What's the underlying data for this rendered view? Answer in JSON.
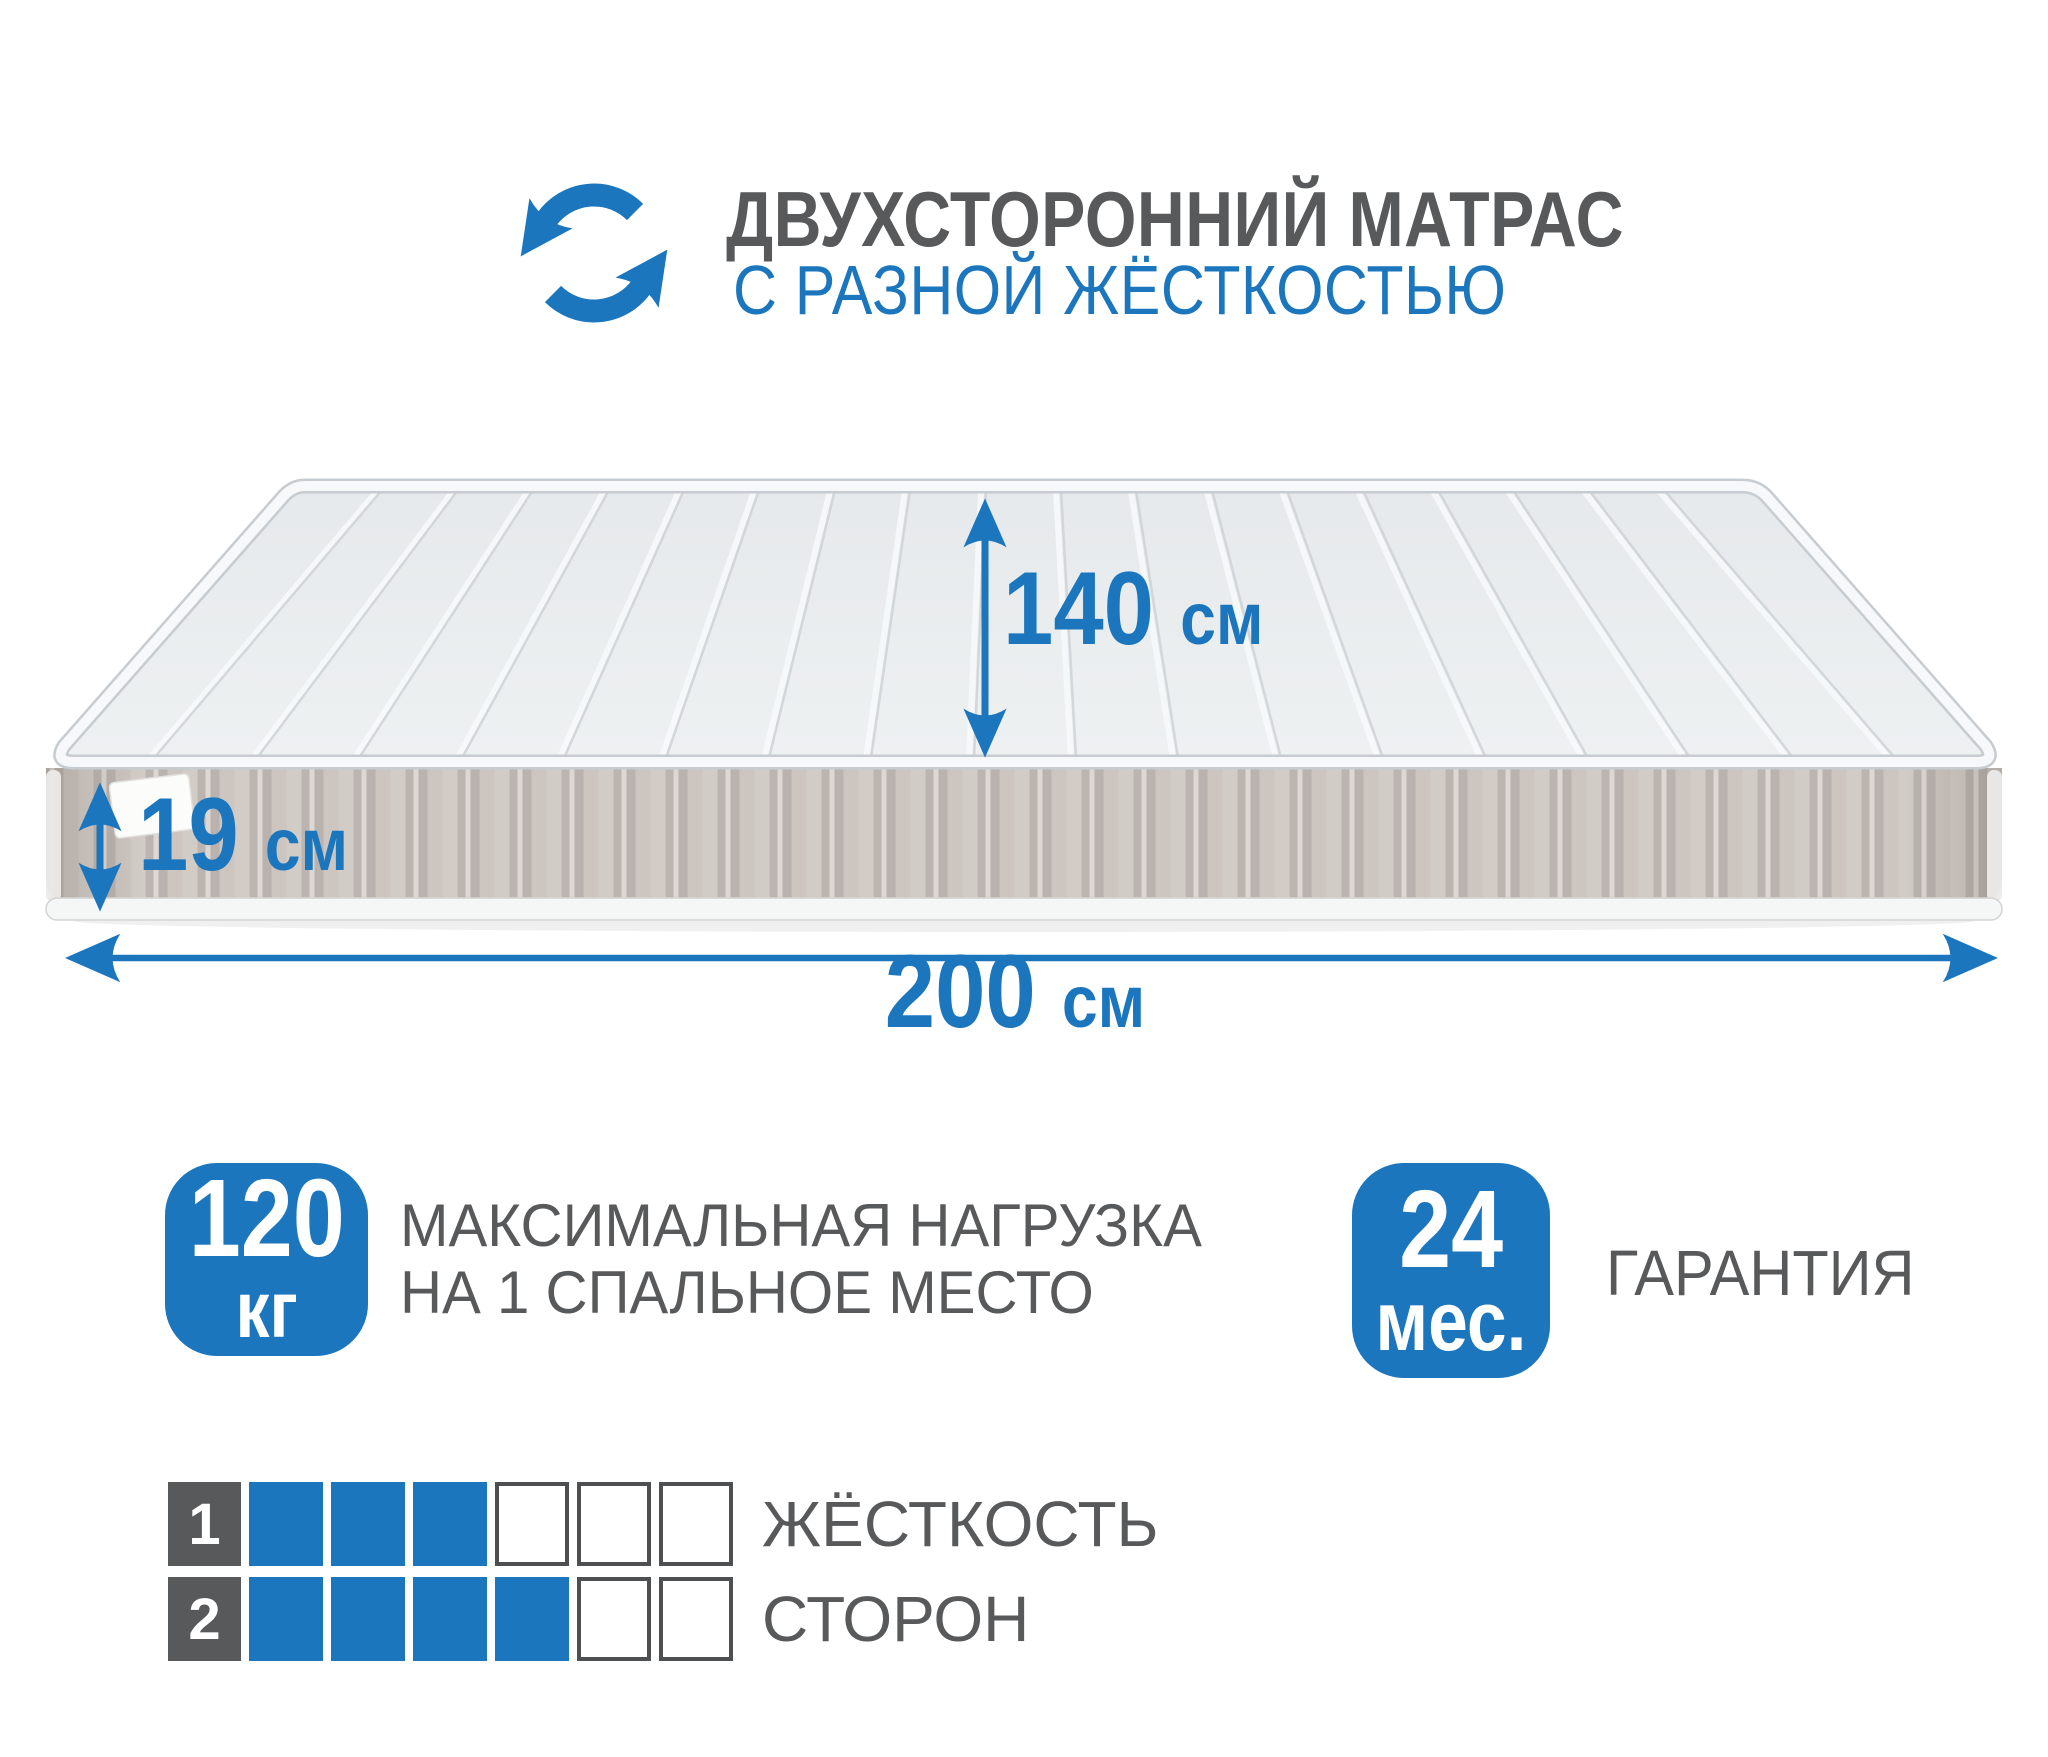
{
  "colors": {
    "accent_blue": "#1b76bd",
    "text_gray": "#58595b",
    "mattress_top": "#e9ecee",
    "mattress_side": "#c9c2bd"
  },
  "header": {
    "icon": "rotate-arrows-icon",
    "title": "ДВУХСТОРОННИЙ МАТРАС",
    "subtitle": "С РАЗНОЙ ЖЁСТКОСТЬЮ"
  },
  "dimensions": {
    "width": {
      "value": "140",
      "unit": "см"
    },
    "height": {
      "value": "19",
      "unit": "см"
    },
    "length": {
      "value": "200",
      "unit": "см"
    }
  },
  "badges": {
    "max_load": {
      "value": "120",
      "unit": "кг",
      "caption_line1": "МАКСИМАЛЬНАЯ НАГРУЗКА",
      "caption_line2": "НА 1 СПАЛЬНОЕ МЕСТО"
    },
    "warranty": {
      "value": "24",
      "unit": "мес.",
      "caption": "ГАРАНТИЯ"
    }
  },
  "firmness": {
    "caption_line1": "ЖЁСТКОСТЬ",
    "caption_line2": "СТОРОН",
    "rows": [
      {
        "side": "1",
        "filled": 3,
        "total": 6
      },
      {
        "side": "2",
        "filled": 4,
        "total": 6
      }
    ]
  },
  "chart_data": {
    "type": "table",
    "title": "ЖЁСТКОСТЬ СТОРОН",
    "categories": [
      "Сторона 1",
      "Сторона 2"
    ],
    "values": [
      3,
      4
    ],
    "ylim": [
      0,
      6
    ]
  }
}
